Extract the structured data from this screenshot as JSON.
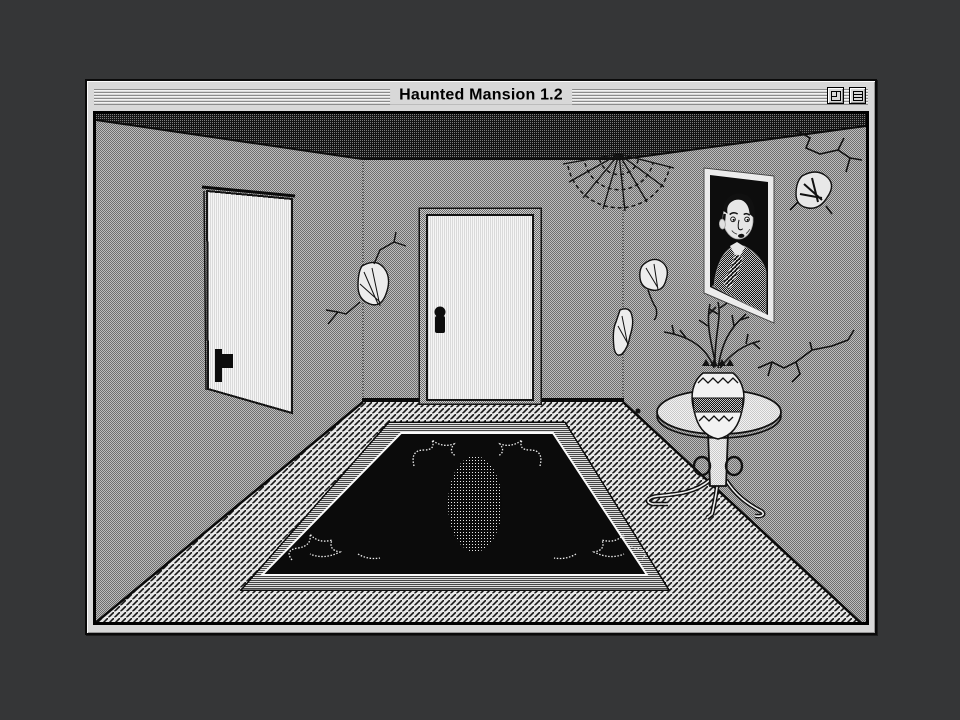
{
  "window": {
    "title": "Haunted Mansion 1.2",
    "controls": [
      {
        "name": "zoom-button",
        "icon": "zoom-box-icon"
      },
      {
        "name": "collapse-button",
        "icon": "windowshade-icon"
      }
    ]
  },
  "scene": {
    "hotspots": [
      "left-door",
      "center-door",
      "rug",
      "rug-medallion",
      "pedestal-table",
      "vase-with-dead-branches",
      "portrait-painting",
      "spider-web",
      "wall-crack-corner",
      "wall-crack-patches",
      "ceiling-crack-with-moth",
      "right-wall-crack"
    ]
  },
  "colors": {
    "desktop_background": "#353637",
    "titlebar_gray": "#d8d8d8",
    "ink_black": "#0a0a0a",
    "wall_dither_gray": "#959595",
    "door_white": "#f6f6f6",
    "rug_black": "#0b0b0b"
  }
}
